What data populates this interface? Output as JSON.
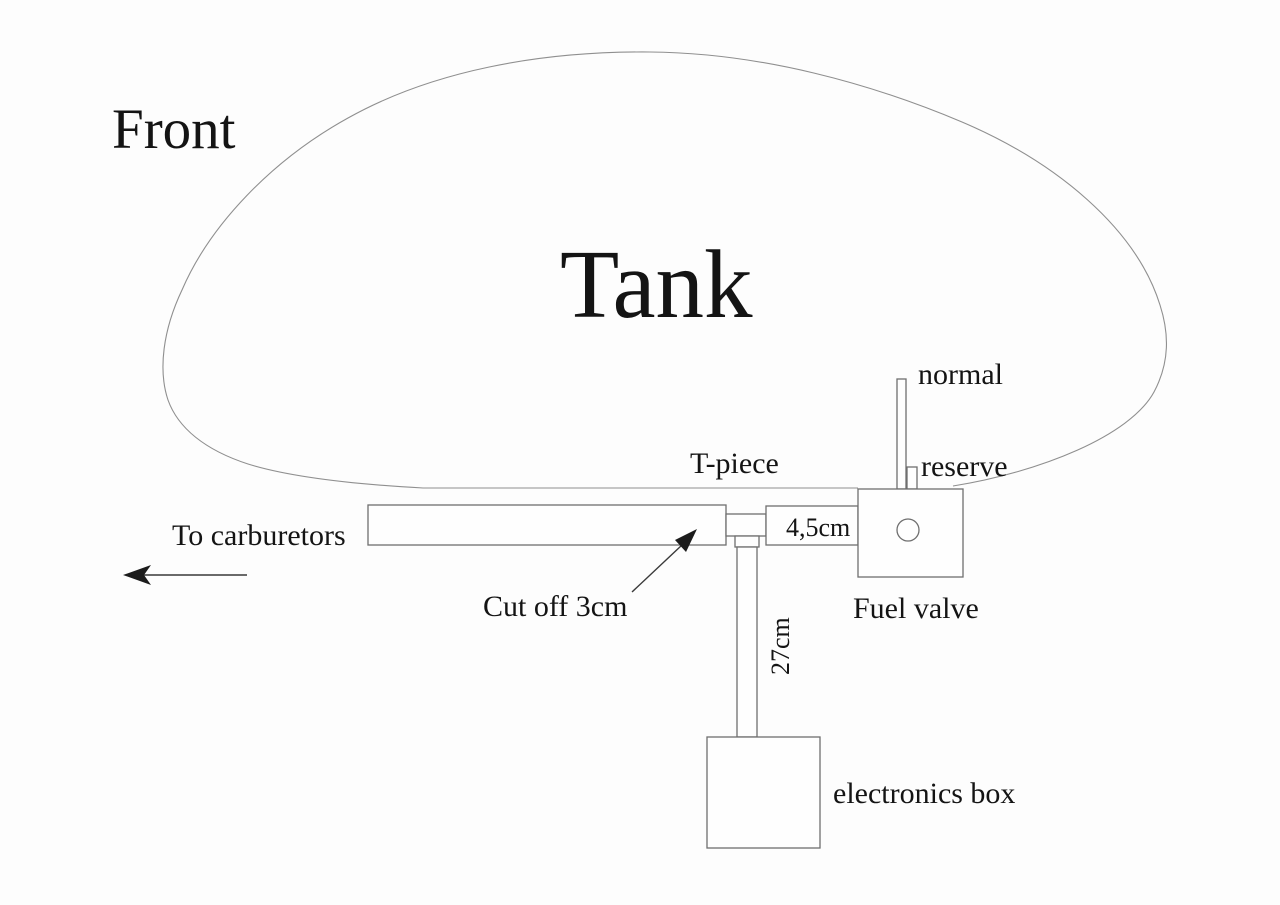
{
  "diagram": {
    "labels": {
      "front": "Front",
      "tank": "Tank",
      "normal": "normal",
      "reserve": "reserve",
      "t_piece": "T-piece",
      "to_carburetors": "To carburetors",
      "hose_length": "4,5cm",
      "cut_off": "Cut off 3cm",
      "fuel_valve": "Fuel valve",
      "drop_length": "27cm",
      "electronics_box": "electronics box"
    },
    "colors": {
      "background": "#fdfdfd",
      "line": "#6f6f6f",
      "tank_outline": "#8f8f8f",
      "text": "#141414"
    }
  }
}
